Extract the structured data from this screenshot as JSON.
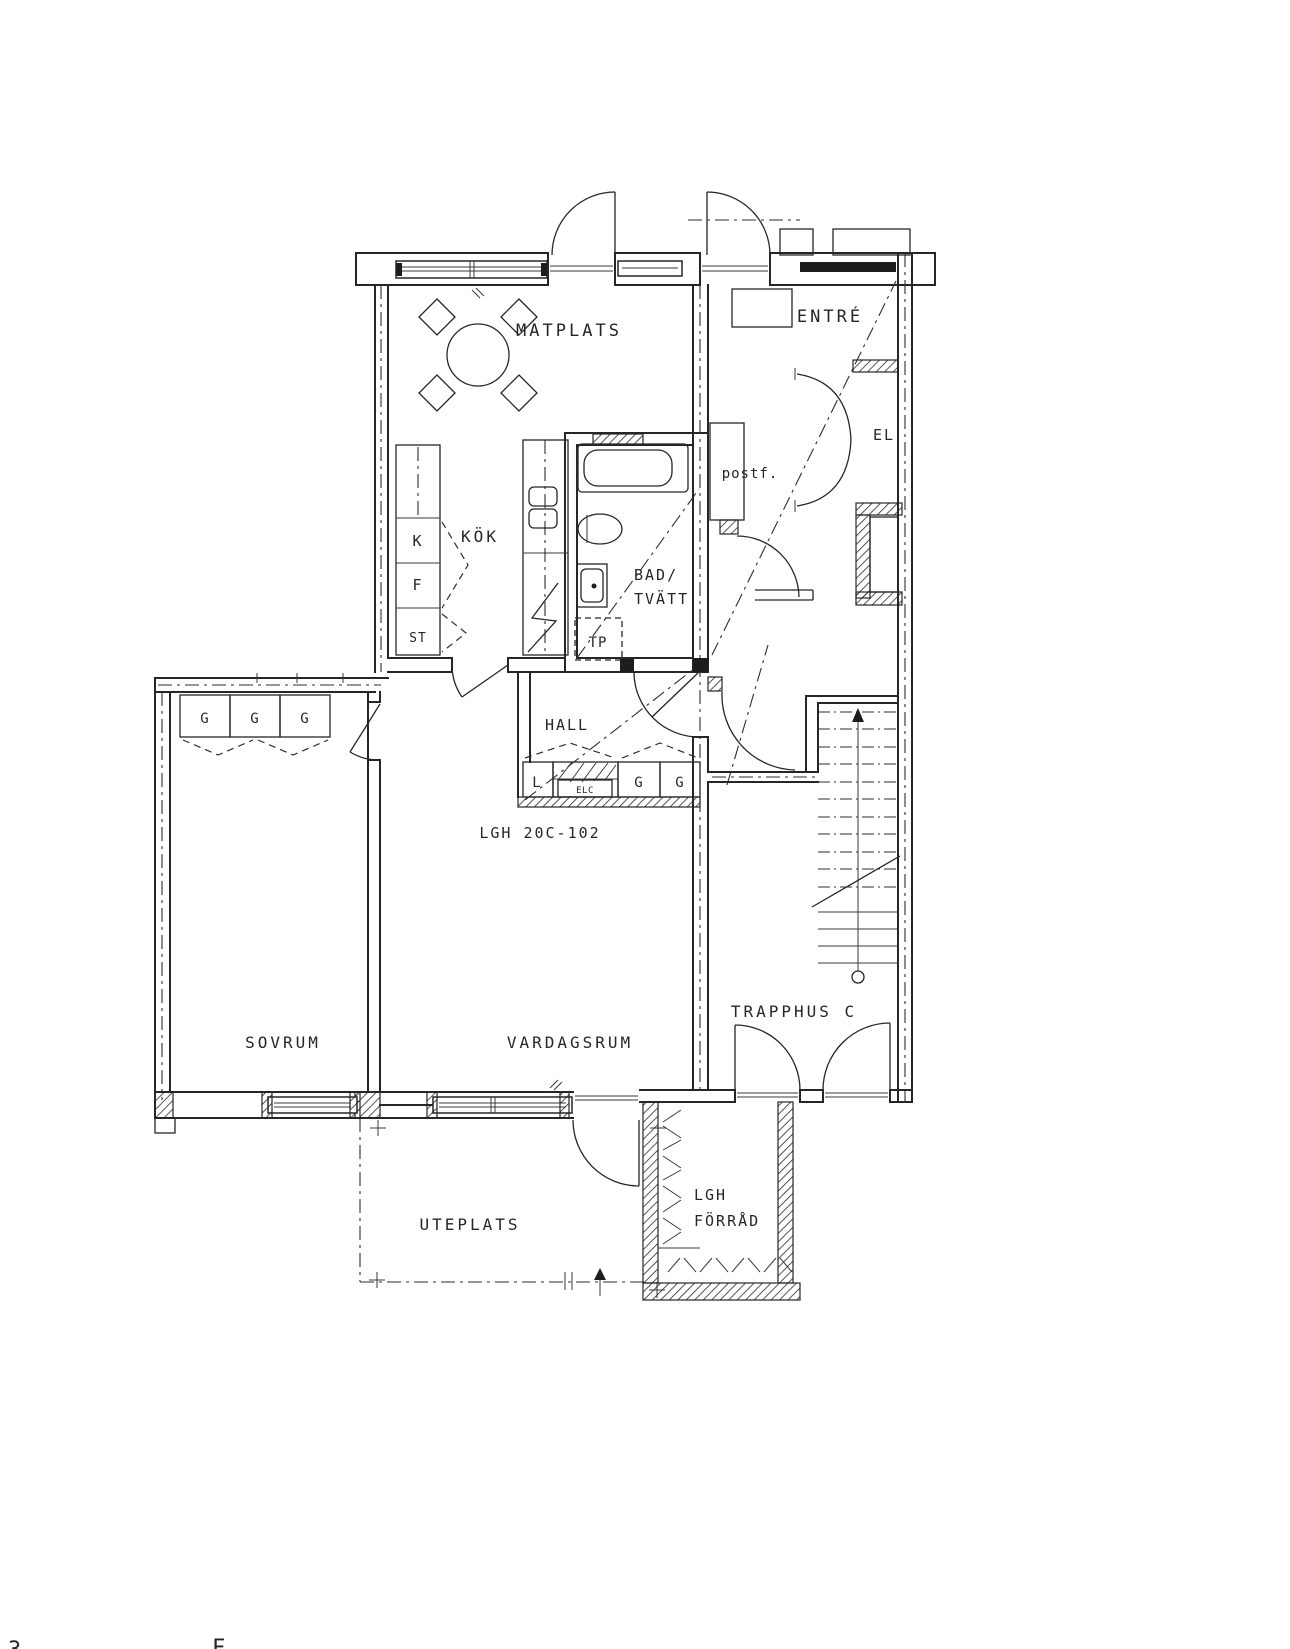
{
  "floor_plan": {
    "apartment_label": "LGH 20C-102",
    "rooms": {
      "matplats": "MATPLATS",
      "entre": "ENTRÉ",
      "el": "EL",
      "postf": "postf.",
      "kok": "KÖK",
      "bad_line1": "BAD/",
      "bad_line2": "TVÄTT",
      "hall": "HALL",
      "sovrum": "SOVRUM",
      "vardagsrum": "VARDAGSRUM",
      "trapphus": "TRAPPHUS C",
      "uteplats": "UTEPLATS",
      "forrad_line1": "LGH",
      "forrad_line2": "FÖRRÅD"
    },
    "fixtures": {
      "kyl": "K",
      "frys": "F",
      "stad": "ST",
      "tvattpelare": "TP",
      "linneskap": "L",
      "garderob": "G",
      "elcentral": "ELC"
    },
    "partial_text": {
      "bottom_left": "3",
      "bottom_mid": "F"
    },
    "colors": {
      "line": "#262626",
      "bg": "#ffffff"
    }
  }
}
